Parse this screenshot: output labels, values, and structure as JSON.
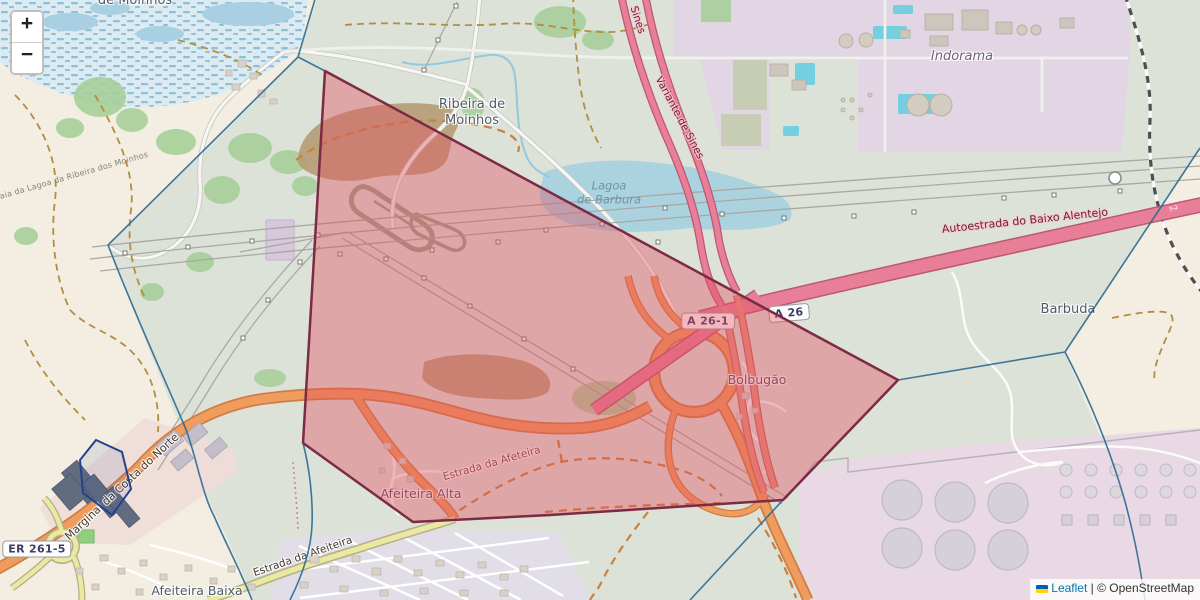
{
  "map": {
    "zoom_control": {
      "zoom_in_label": "+",
      "zoom_out_label": "−"
    },
    "attribution": {
      "leaflet_label": "Leaflet",
      "separator": " | ",
      "copyright": "© OpenStreetMap"
    }
  },
  "place_labels": {
    "moinhos_top": {
      "text": "de Moinhos"
    },
    "ribeira": {
      "line1": "Ribeira de",
      "line2": "Moinhos"
    },
    "lagoa": {
      "line1": "Lagoa",
      "line2": "de Barbura"
    },
    "indorama": {
      "text": "Indorama"
    },
    "barbuda": {
      "text": "Barbuda"
    },
    "bolbugao": {
      "text": "Bolbugão"
    },
    "afeiteira_alta": {
      "text": "Afeiteira Alta"
    },
    "afeiteira_baixa": {
      "text": "Afeiteira Baixa"
    },
    "praia": {
      "text": "Praia da Lagoa da Ribeira dos Moinhos"
    }
  },
  "road_labels": {
    "marginal": {
      "text": "Marginal da Costa do Norte"
    },
    "estrada_afeiteira": {
      "text": "Estrada da Afeiteira"
    },
    "estrada_afeteira": {
      "text": "Estrada da Afeteira"
    },
    "autoestrada": {
      "text": "Autoestrada do Baixo Alentejo"
    },
    "variante": {
      "text": "Variante de Sines"
    },
    "sines": {
      "text": "Sines"
    },
    "exit_2": {
      "text": "2"
    }
  },
  "road_shields": {
    "a26_1": "A 26-1",
    "a26": "A 26",
    "er261_5": "ER 261-5"
  },
  "colors": {
    "red_polygon_fill": "#e44d5c",
    "red_polygon_stroke": "#7c2b45",
    "voronoi_line": "#2e6d94",
    "motorway": "#e87e97",
    "trunk": "#ef9c5e",
    "tertiary_road": "#eae8a2",
    "water": "#aad3df",
    "industrial_area": "#e2d5e4",
    "forest": "#a7cf9a",
    "leaflet_link": "#0078a8"
  }
}
